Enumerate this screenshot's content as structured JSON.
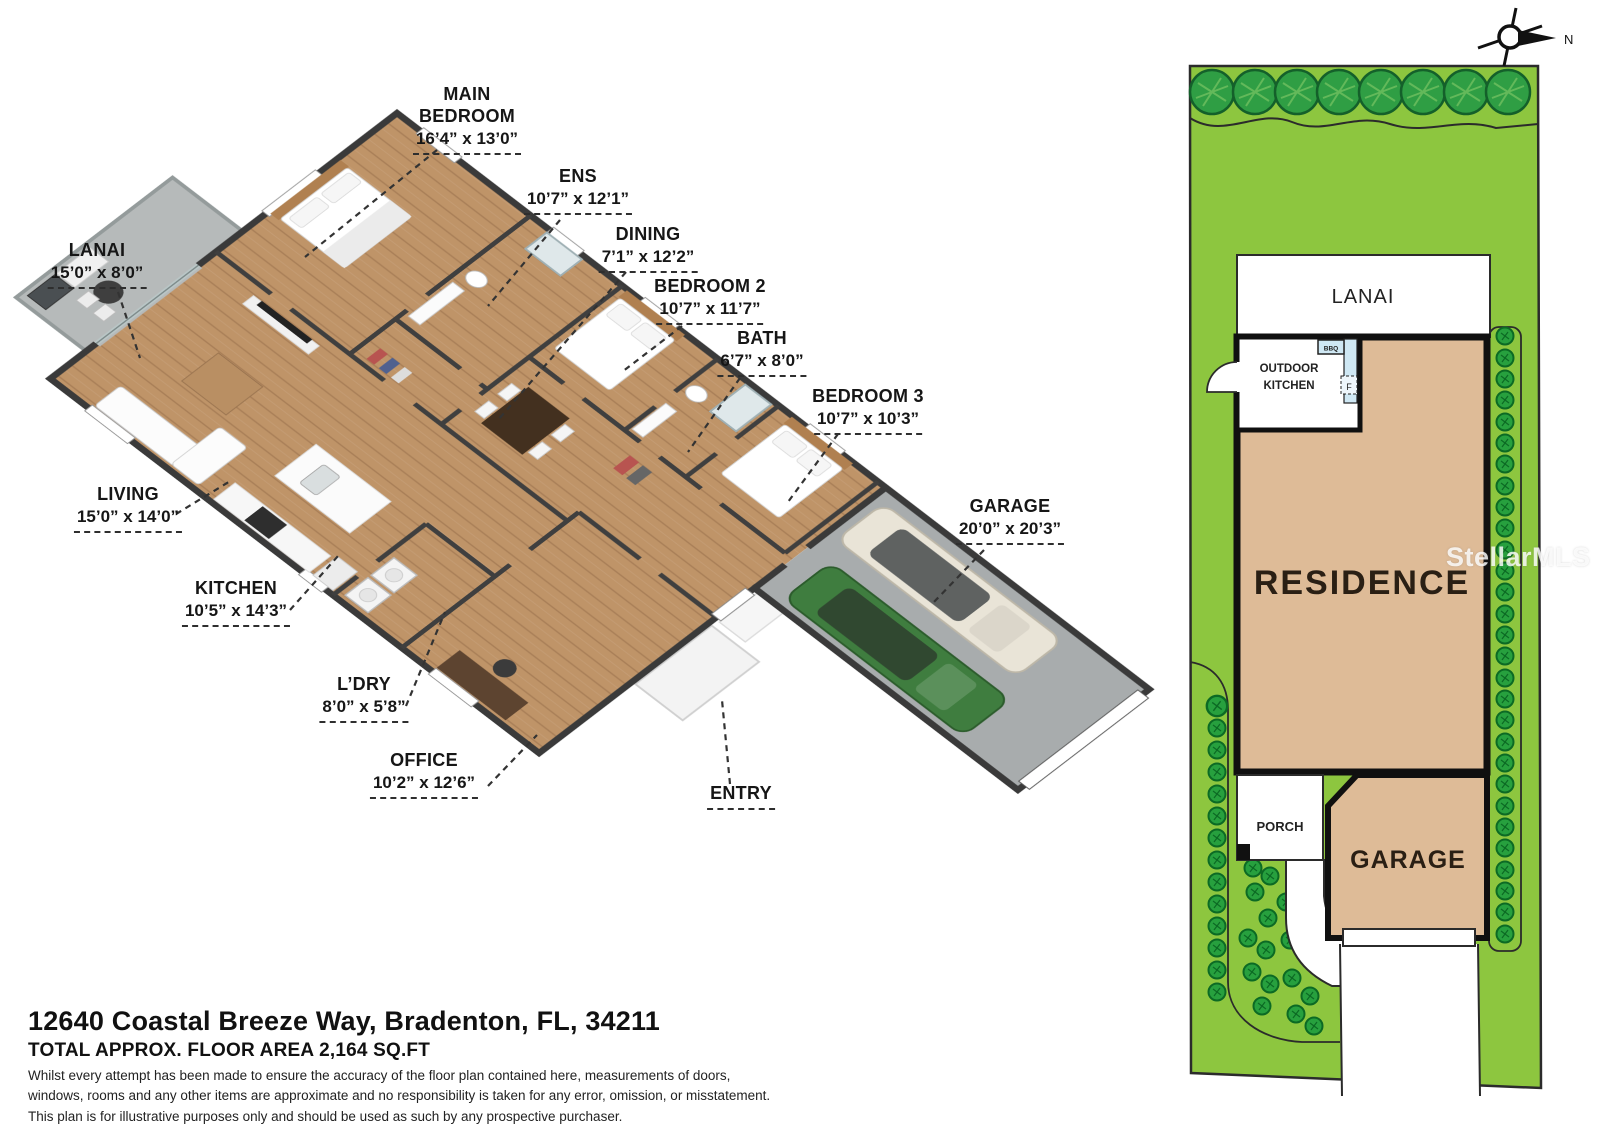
{
  "floor_plan": {
    "rooms": [
      {
        "label": "MAIN BEDROOM",
        "dims": "16’4” x 13’0”"
      },
      {
        "label": "ENS",
        "dims": "10’7” x 12’1”"
      },
      {
        "label": "DINING",
        "dims": "7’1” x 12’2”"
      },
      {
        "label": "BEDROOM 2",
        "dims": "10’7” x 11’7”"
      },
      {
        "label": "BATH",
        "dims": "6’7” x 8’0”"
      },
      {
        "label": "BEDROOM 3",
        "dims": "10’7” x 10’3”"
      },
      {
        "label": "LANAI",
        "dims": "15’0” x 8’0”"
      },
      {
        "label": "LIVING",
        "dims": "15’0” x 14’0”"
      },
      {
        "label": "KITCHEN",
        "dims": "10’5” x 14’3”"
      },
      {
        "label": "L’DRY",
        "dims": "8’0” x 5’8”"
      },
      {
        "label": "OFFICE",
        "dims": "10’2” x 12’6”"
      },
      {
        "label": "ENTRY",
        "dims": ""
      },
      {
        "label": "GARAGE",
        "dims": "20’0” x 20’3”"
      }
    ]
  },
  "site_plan": {
    "lanai": "LANAI",
    "outdoor_kitchen_line1": "OUTDOOR",
    "outdoor_kitchen_line2": "KITCHEN",
    "bbq": "BBQ",
    "fridge": "F",
    "residence": "RESIDENCE",
    "porch": "PORCH",
    "garage": "GARAGE"
  },
  "compass": {
    "north_label": "N"
  },
  "watermark": {
    "text": "StellarMLS"
  },
  "footer": {
    "address": "12640 Coastal Breeze Way, Bradenton, FL, 34211",
    "area": "TOTAL APPROX. FLOOR AREA 2,164 SQ.FT",
    "disclaimer_line1": "Whilst every attempt has been made to ensure the accuracy of the floor plan contained here, measurements of doors,",
    "disclaimer_line2": "windows, rooms and any other items are approximate and no responsibility is taken for any error, omission, or misstatement.",
    "disclaimer_line3": "This plan is for illustrative purposes only and should be used as such by any prospective purchaser."
  },
  "colors": {
    "lot_green": "#8dc63f",
    "tree_green": "#2f9e44",
    "bush_green": "#27a03e",
    "residence_tan": "#debb97",
    "wall_dark": "#3a3a3a",
    "wood_floor": "#bf9468",
    "concrete": "#a8acad",
    "lanai_floor": "#b6baba",
    "car_green": "#3f7d3f",
    "car_white": "#e9e4d7",
    "counter_blue": "#cfe8f4",
    "label_text": "#161616"
  }
}
